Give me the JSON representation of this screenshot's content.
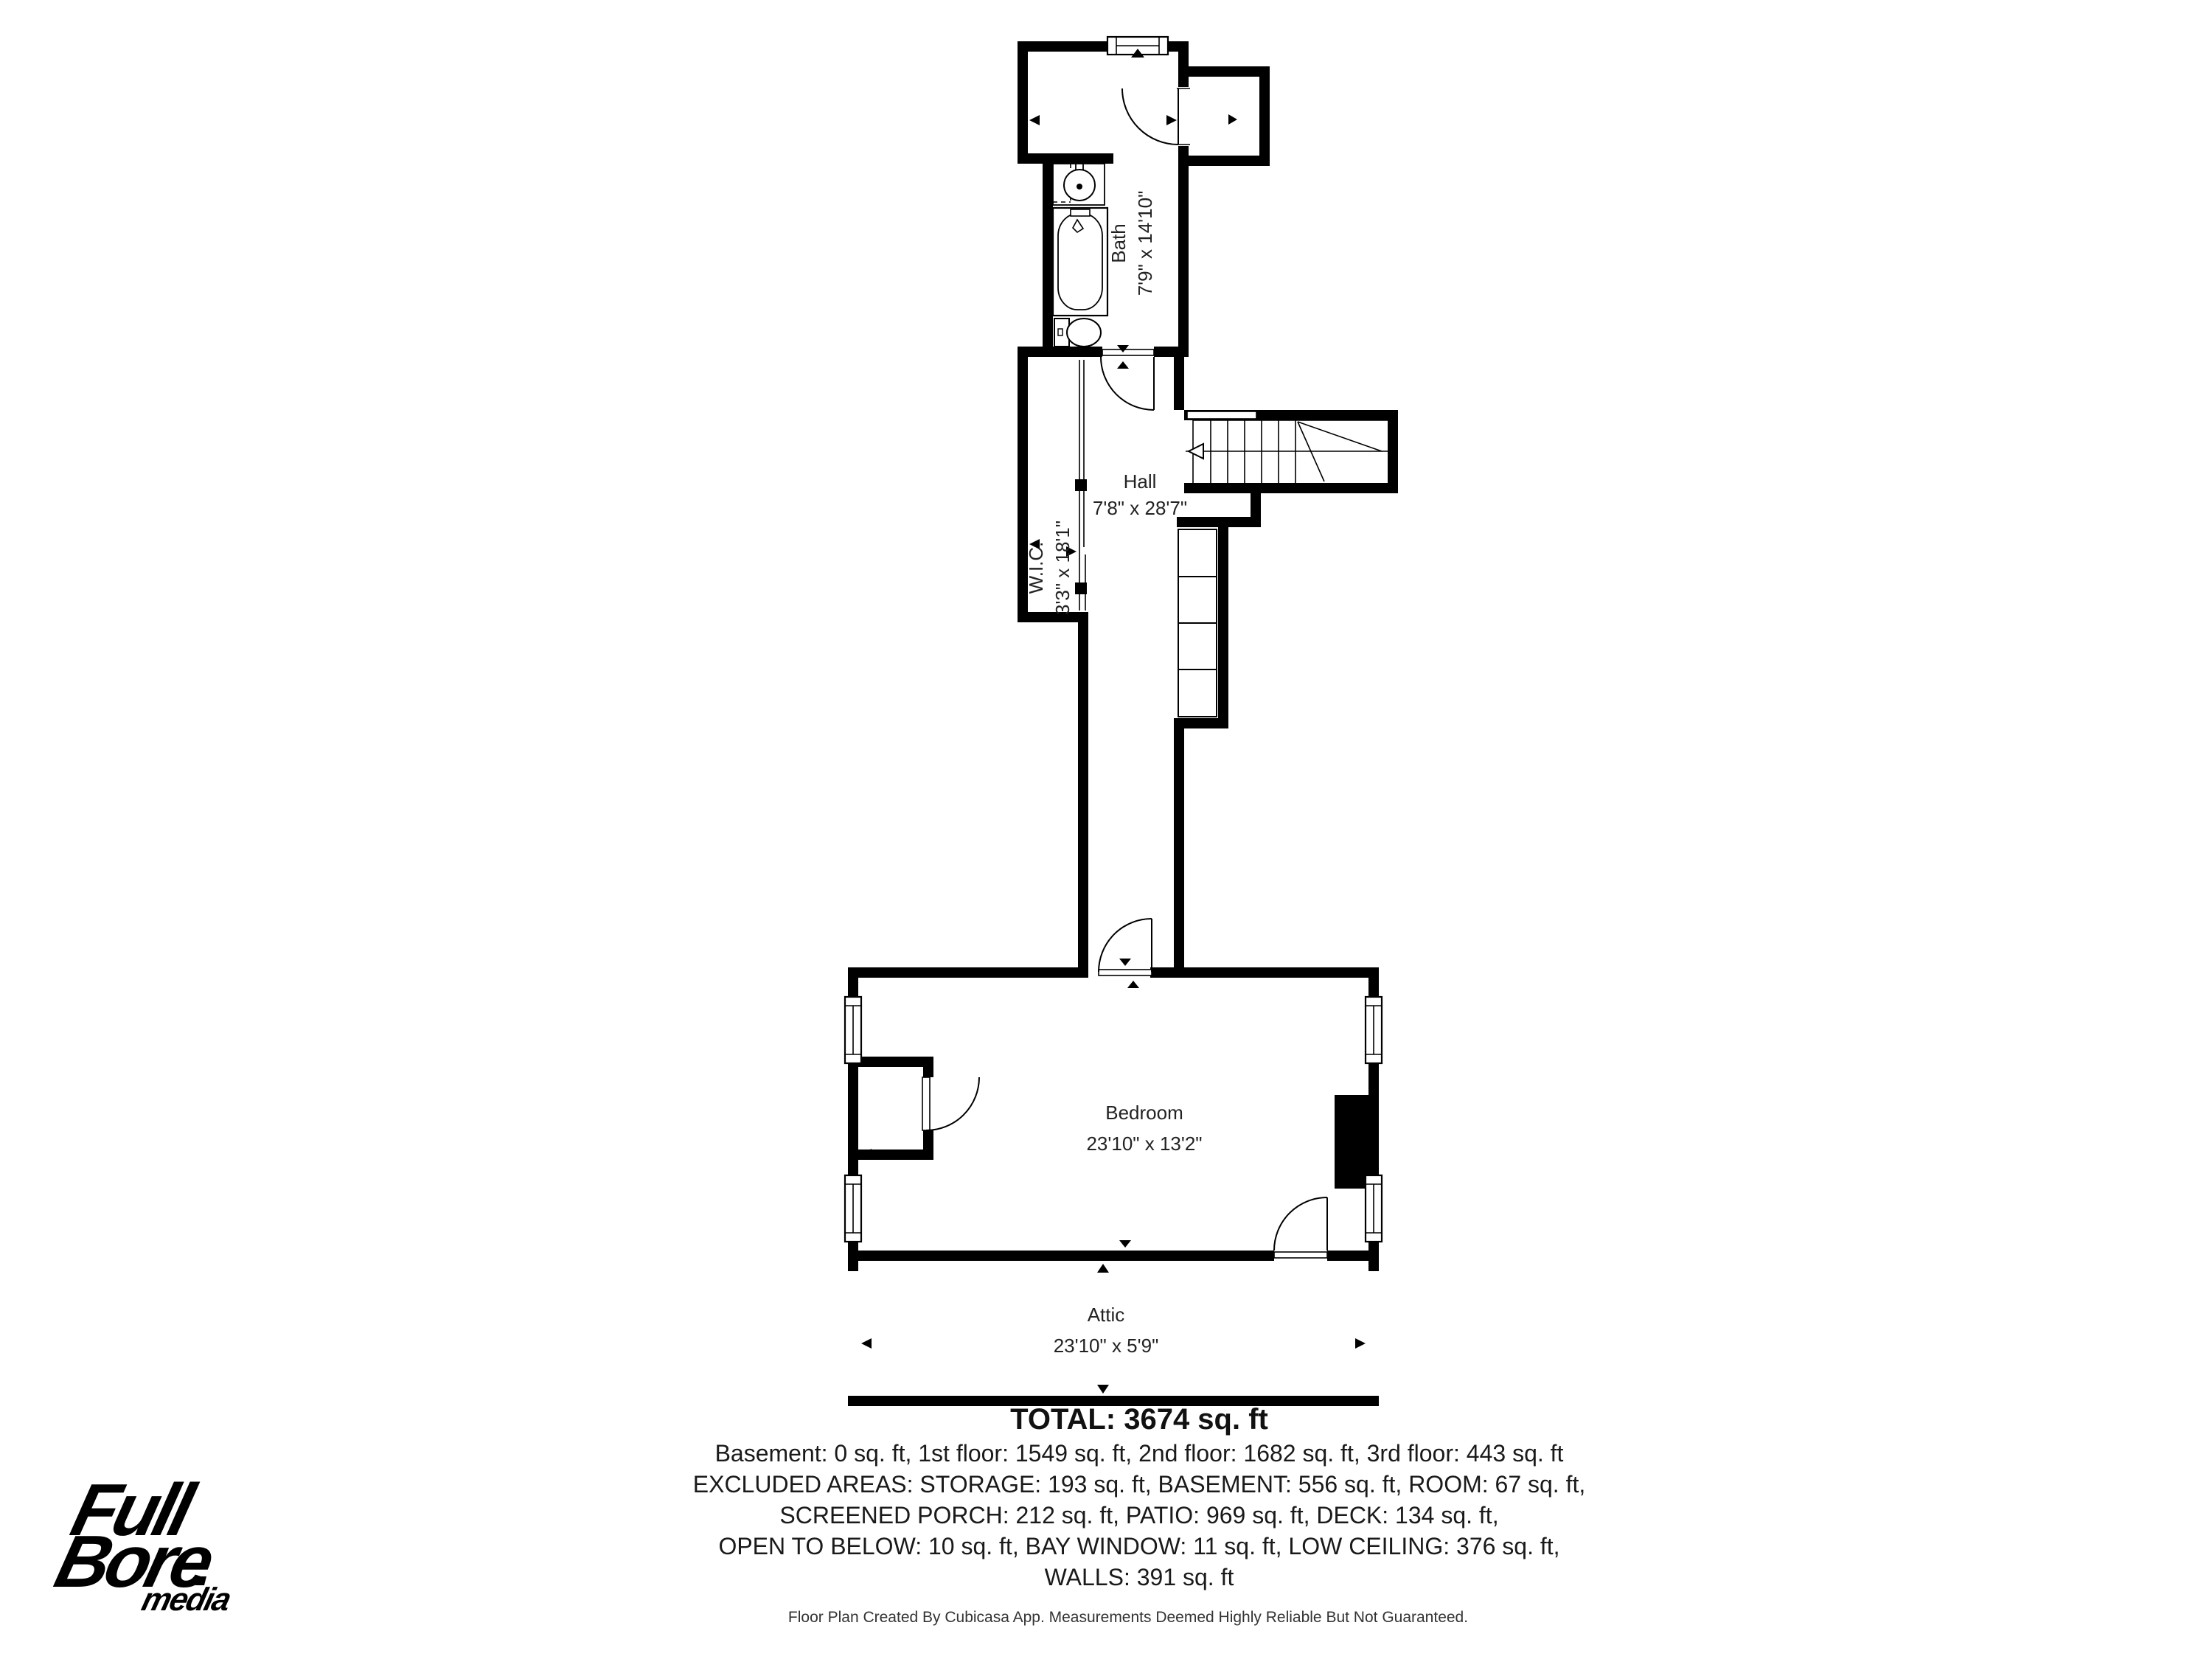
{
  "rooms": {
    "bath": {
      "name": "Bath",
      "dims": "7'9\" x 14'10\""
    },
    "hall": {
      "name": "Hall",
      "dims": "7'8\" x 28'7\""
    },
    "wic": {
      "name": "W.I.C.",
      "dims": "3'3\" x 18'1\""
    },
    "bedroom": {
      "name": "Bedroom",
      "dims": "23'10\" x 13'2\""
    },
    "attic": {
      "name": "Attic",
      "dims": "23'10\" x 5'9\""
    }
  },
  "summary": {
    "total": "TOTAL: 3674 sq. ft",
    "lines": [
      "Basement: 0 sq. ft, 1st floor: 1549 sq. ft, 2nd floor: 1682 sq. ft, 3rd floor: 443 sq. ft",
      "EXCLUDED AREAS: STORAGE: 193 sq. ft, BASEMENT: 556 sq. ft, ROOM: 67 sq. ft,",
      "SCREENED PORCH: 212 sq. ft, PATIO: 969 sq. ft, DECK: 134 sq. ft,",
      "OPEN TO BELOW: 10 sq. ft, BAY WINDOW: 11 sq. ft, LOW CEILING: 376 sq. ft,",
      "WALLS: 391 sq. ft"
    ]
  },
  "footer": "Floor Plan Created By Cubicasa App. Measurements Deemed Highly Reliable But Not Guaranteed.",
  "logo": {
    "word1": "Full",
    "word2": "Bore",
    "word3": "media"
  },
  "colors": {
    "wall": "#000000",
    "background": "#ffffff",
    "text": "#1a1a1a"
  }
}
